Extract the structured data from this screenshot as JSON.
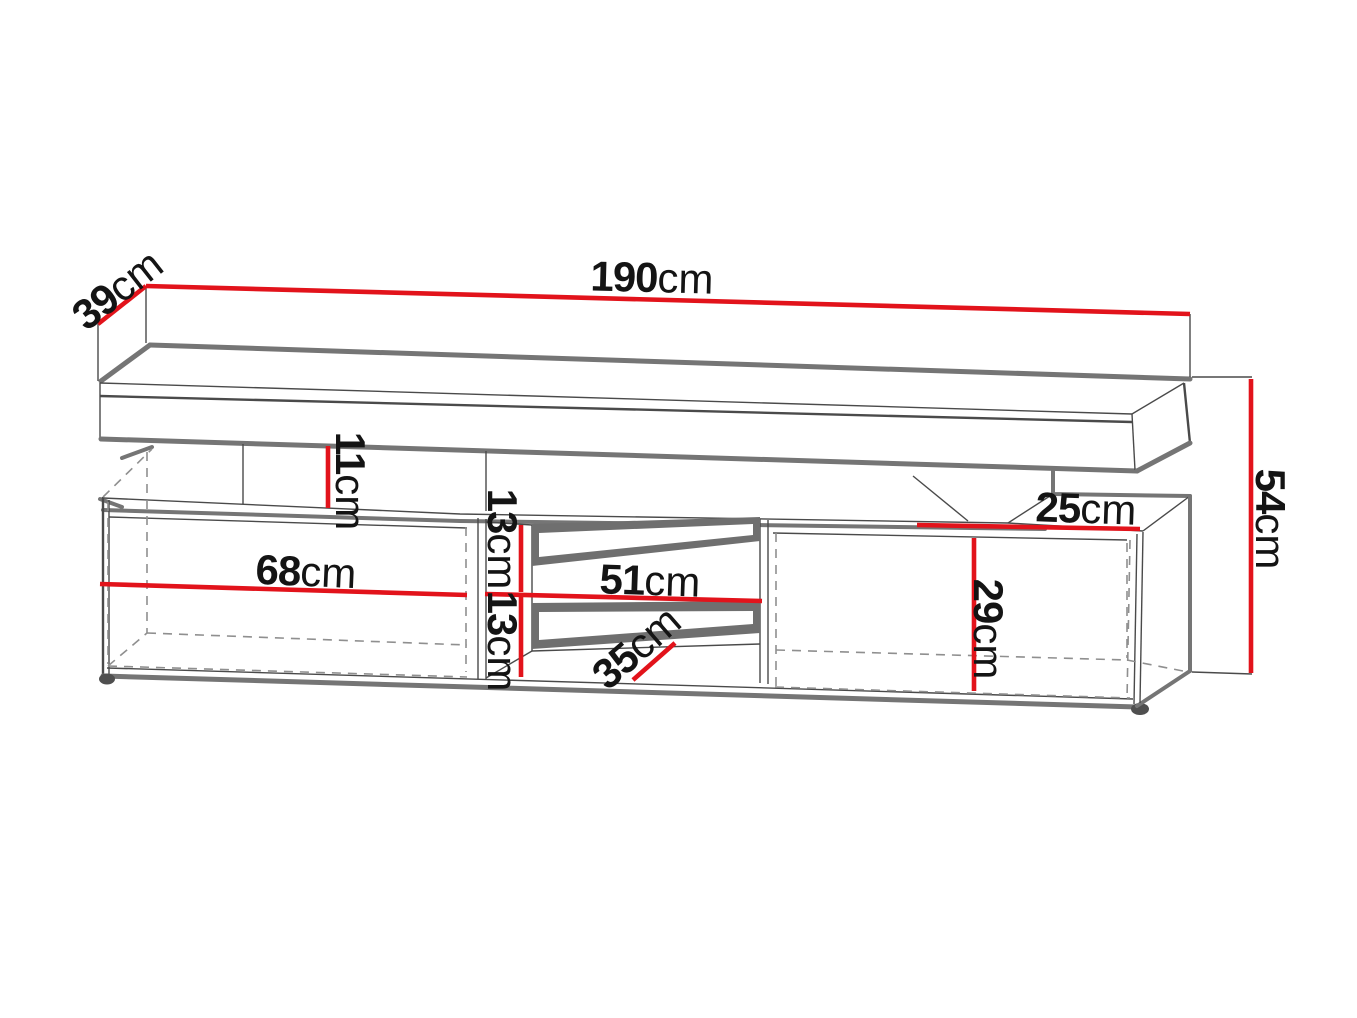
{
  "diagram": {
    "title": "TV stand dimension diagram",
    "type": "furniture technical line drawing",
    "subject": "TV cabinet with floating top shelf, open left compartment, middle shelf niche and open right compartment",
    "units": "cm",
    "colors": {
      "red": "#e2131b",
      "ink": "#4a4a4a",
      "shadow": "#757575",
      "dash": "#8f8f8f",
      "band": "#6f6f6f",
      "bg": "#ffffff",
      "label": "#141414"
    },
    "dimensions": [
      {
        "id": "total-width",
        "value": "190",
        "unit": "cm",
        "orientation": "horizontal",
        "location": "top back edge"
      },
      {
        "id": "depth",
        "value": "39",
        "unit": "cm",
        "orientation": "diagonal",
        "location": "top left edge"
      },
      {
        "id": "shelf-gap-height",
        "value": "11",
        "unit": "cm",
        "orientation": "vertical",
        "location": "gap between floating shelf and cabinet top"
      },
      {
        "id": "total-height",
        "value": "54",
        "unit": "cm",
        "orientation": "vertical",
        "location": "right side overall"
      },
      {
        "id": "right-top-depth",
        "value": "25",
        "unit": "cm",
        "orientation": "horizontal",
        "location": "exposed right cabinet top"
      },
      {
        "id": "left-compartment-width",
        "value": "68",
        "unit": "cm",
        "orientation": "horizontal",
        "location": "left open compartment"
      },
      {
        "id": "niche-upper-height",
        "value": "13",
        "unit": "cm",
        "orientation": "vertical",
        "location": "upper niche opening"
      },
      {
        "id": "niche-lower-height",
        "value": "13",
        "unit": "cm",
        "orientation": "vertical",
        "location": "lower niche opening"
      },
      {
        "id": "niche-width",
        "value": "51",
        "unit": "cm",
        "orientation": "horizontal",
        "location": "middle niche"
      },
      {
        "id": "niche-depth",
        "value": "35",
        "unit": "cm",
        "orientation": "diagonal",
        "location": "middle niche depth"
      },
      {
        "id": "right-compartment-height",
        "value": "29",
        "unit": "cm",
        "orientation": "vertical",
        "location": "right open compartment"
      }
    ]
  }
}
